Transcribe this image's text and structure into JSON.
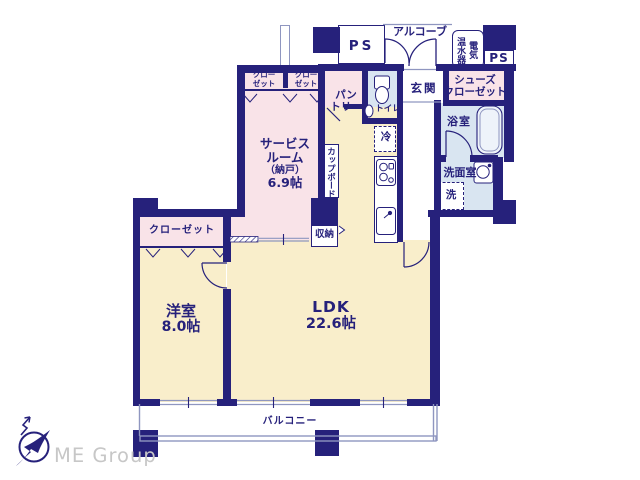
{
  "rooms": {
    "service_room": {
      "line1": "サービス",
      "line2": "ルーム",
      "line3": "（納戸）",
      "size": "6.9帖"
    },
    "western": {
      "name": "洋室",
      "size": "8.0帖"
    },
    "ldk": {
      "name": "LDK",
      "size": "22.6帖"
    },
    "balcony": "バルコニー",
    "genkan": "玄関",
    "toilet": "トイレ",
    "bath": "浴室",
    "washroom": "洗面室",
    "pantry_line1": "パン",
    "pantry_line2": "トリー",
    "shoes_line1": "シューズ",
    "shoes_line2": "クローゼット",
    "closet_west": "クローゼット",
    "closet_a_line1": "クロー",
    "closet_a_line2": "ゼット",
    "closet_b_line1": "クロー",
    "closet_b_line2": "ゼット"
  },
  "fixtures": {
    "ps_left": "PS",
    "ps_right": "PS",
    "alcove": "アルコーブ",
    "water_heater_right": "電気",
    "water_heater_left": "温水器",
    "fridge": "冷",
    "cupboard": "カップボード",
    "storage": "収納",
    "washer": "洗"
  },
  "brand": {
    "name": "ME Group"
  },
  "colors": {
    "wall": "#26217b",
    "room_pink": "#f9e3e8",
    "room_cream": "#f9eecb",
    "room_wet_blue": "#d9e5f1",
    "thin_line": "#8f96c0",
    "brand_gray": "#c7c7c7"
  }
}
